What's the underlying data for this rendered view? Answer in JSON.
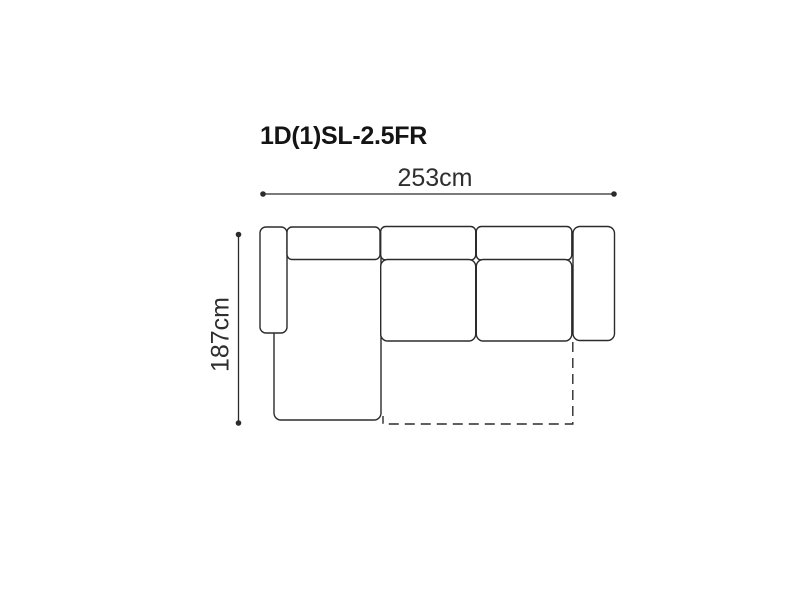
{
  "title": "1D(1)SL-2.5FR",
  "dimensions": {
    "width": "253cm",
    "height": "187cm"
  },
  "diagram": {
    "type": "sofa-top-view-floorplan",
    "description_parts": [
      "left-armrest",
      "chaise-longue-seat",
      "backrest-cushion-1",
      "backrest-cushion-2",
      "backrest-cushion-3",
      "seat-cushion-1",
      "seat-cushion-2",
      "right-armrest",
      "fold-out-bed-dashed-footprint"
    ],
    "colors": {
      "line": "#2b2b2b",
      "text": "#2e2e2e",
      "title": "#141414",
      "background": "#ffffff"
    }
  }
}
